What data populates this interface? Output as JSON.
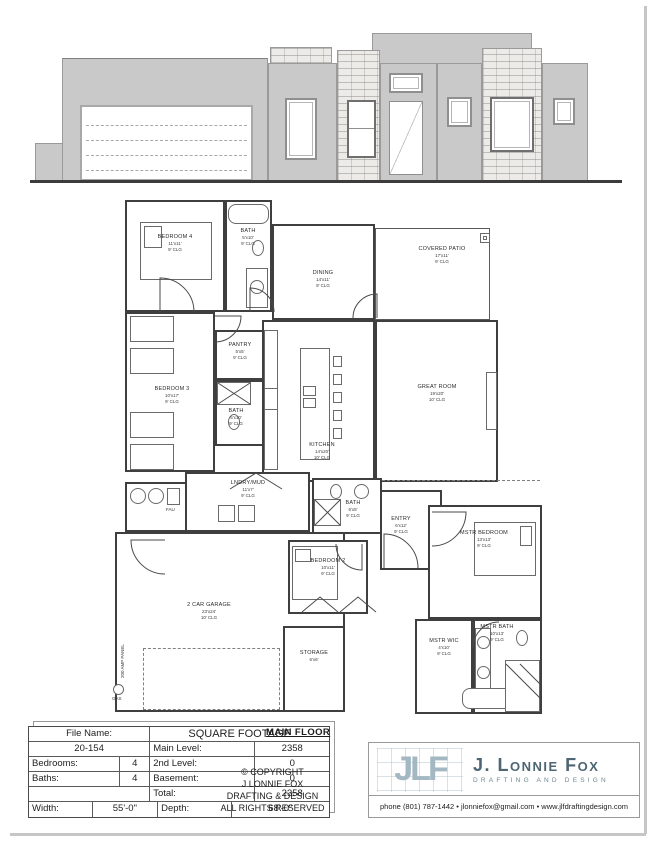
{
  "sheet": {
    "background": "#ffffff",
    "wall_color": "#3f3f3f",
    "elevation_wall": "#c9c9c9",
    "stone": "#edebe7"
  },
  "floor_plan": {
    "main_floor_label": "MAIN FLOOR",
    "rooms": [
      {
        "name": "BEDROOM 4",
        "dims": "11'x11'",
        "clg": "9' CLG"
      },
      {
        "name": "BATH",
        "dims": "5'x10'",
        "clg": "9' CLG"
      },
      {
        "name": "DINING",
        "dims": "14'x11'",
        "clg": "9' CLG"
      },
      {
        "name": "COVERED PATIO",
        "dims": "17'x11'",
        "clg": "9' CLG"
      },
      {
        "name": "GREAT ROOM",
        "dims": "19'x20'",
        "clg": "10' CLG"
      },
      {
        "name": "KITCHEN",
        "dims": "14'x20'",
        "clg": "10' CLG"
      },
      {
        "name": "PANTRY",
        "dims": "5'x5'",
        "clg": "9' CLG"
      },
      {
        "name": "BATH",
        "dims": "5'x10'",
        "clg": "9' CLG"
      },
      {
        "name": "BEDROOM 3",
        "dims": "10'x17'",
        "clg": "9' CLG"
      },
      {
        "name": "LNDRY/MUD",
        "dims": "11'x7'",
        "clg": "9' CLG"
      },
      {
        "name": "BATH",
        "dims": "6'x5'",
        "clg": "9' CLG"
      },
      {
        "name": "ENTRY",
        "dims": "6'x12'",
        "clg": "9' CLG"
      },
      {
        "name": "BEDROOM 2",
        "dims": "10'x11'",
        "clg": "9' CLG"
      },
      {
        "name": "MSTR BEDROOM",
        "dims": "13'x13'",
        "clg": "9' CLG"
      },
      {
        "name": "2 CAR GARAGE",
        "dims": "23'x24'",
        "clg": "10' CLG"
      },
      {
        "name": "STORAGE",
        "dims": "6'x6'",
        "clg": ""
      },
      {
        "name": "MSTR WIC",
        "dims": "4'x10'",
        "clg": "9' CLG"
      },
      {
        "name": "MSTR BATH",
        "dims": "10'x13'",
        "clg": "9' CLG"
      }
    ],
    "annotations": {
      "amp_panel": "200 AMP PANEL",
      "gas": "GAS",
      "fau": "FAU"
    }
  },
  "title_block": {
    "file_name_label": "File Name:",
    "file_name_value": "20-154",
    "sqft_header": "SQUARE FOOTAGE",
    "main_level_label": "Main Level:",
    "main_level_value": "2358",
    "bedrooms_label": "Bedrooms:",
    "bedrooms_value": "4",
    "second_level_label": "2nd Level:",
    "second_level_value": "0",
    "baths_label": "Baths:",
    "baths_value": "4",
    "basement_label": "Basement:",
    "basement_value": "0",
    "total_label": "Total:",
    "total_value": "2358",
    "width_label": "Width:",
    "width_value": "55'-0\"",
    "depth_label": "Depth:",
    "depth_value": "68'-0\""
  },
  "copyright": {
    "line1": "© COPYRIGHT",
    "line2": "J LONNIE FOX",
    "line3": "DRAFTING & DESIGN",
    "line4": "ALL RIGHTS RESERVED"
  },
  "logo": {
    "monogram": "JLF",
    "name": "J. Lonnie Fox",
    "tagline": "DRAFTING AND DESIGN",
    "contact": "phone (801) 787-1442 • jlonniefox@gmail.com • www.jlfdraftingdesign.com",
    "accent_color": "#a3b8c2",
    "name_color": "#4e6673"
  }
}
